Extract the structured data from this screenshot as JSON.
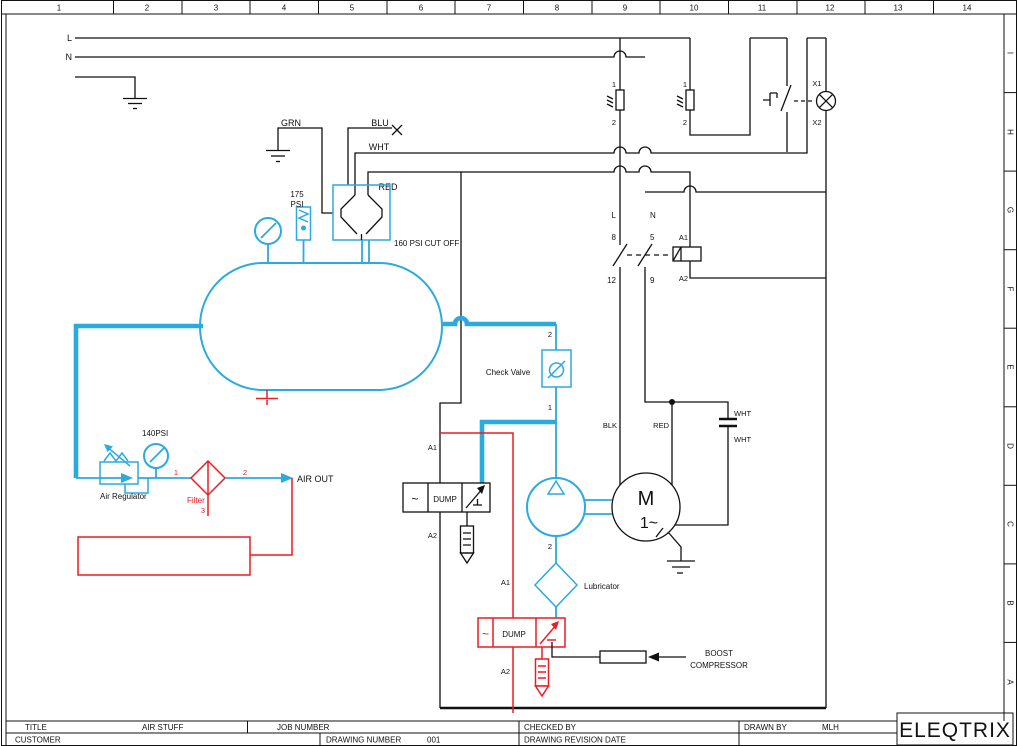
{
  "colors": {
    "blue": "#2aaade",
    "red": "#ec1c24",
    "line": "#111111"
  },
  "frame": {
    "ruler": [
      "1",
      "2",
      "3",
      "4",
      "5",
      "6",
      "7",
      "8",
      "9",
      "10",
      "11",
      "12",
      "13",
      "14"
    ],
    "zones": [
      "I",
      "H",
      "G",
      "F",
      "E",
      "D",
      "C",
      "B",
      "A"
    ]
  },
  "title_block": {
    "title_label": "TITLE",
    "title_value": "AIR STUFF",
    "job_label": "JOB NUMBER",
    "checked_label": "CHECKED BY",
    "drawn_label": "DRAWN BY",
    "drawn_value": "MLH",
    "customer_label": "CUSTOMER",
    "dwg_num_label": "DRAWING NUMBER",
    "dwg_num_value": "001",
    "rev_label": "DRAWING REVISION DATE",
    "logo": "ELEQTRIX"
  },
  "supply": {
    "l": "L",
    "n": "N"
  },
  "fuses": {
    "f1_top": "1",
    "f1_bot": "2",
    "f2_top": "1",
    "f2_bot": "2"
  },
  "wires": {
    "grn": "GRN",
    "blu": "BLU",
    "wht": "WHT",
    "red": "RED",
    "blk": "BLK",
    "red_motor": "RED",
    "wht_cap_top": "WHT",
    "wht_cap_bot": "WHT"
  },
  "pressure_switch": {
    "psi_line1": "175",
    "psi_line2": "PSI",
    "cutoff": "160 PSI CUT OFF"
  },
  "lamp": {
    "x1": "X1",
    "x2": "X2"
  },
  "contactor": {
    "l": "L",
    "n": "N",
    "t8": "8",
    "t5": "5",
    "t12": "12",
    "t9": "9",
    "a1": "A1",
    "a2": "A2"
  },
  "motor": {
    "m": "M",
    "phase": "1~"
  },
  "air_circuit": {
    "regulator_psi": "140PSI",
    "regulator_label": "Air Regulator",
    "filter_label": "Filter",
    "p1": "1",
    "p2": "2",
    "p3": "3",
    "air_out": "AIR OUT"
  },
  "check_valve": {
    "label": "Check Valve",
    "p2": "2",
    "p1": "1"
  },
  "pump": {
    "p2": "2",
    "lubricator": "Lubricator"
  },
  "dump1": {
    "ac": "~",
    "label": "DUMP",
    "a1": "A1",
    "a2": "A2"
  },
  "dump2": {
    "ac": "~",
    "label": "DUMP",
    "a1": "A1",
    "a2": "A2"
  },
  "boost": {
    "line1": "BOOST",
    "line2": "COMPRESSOR"
  }
}
